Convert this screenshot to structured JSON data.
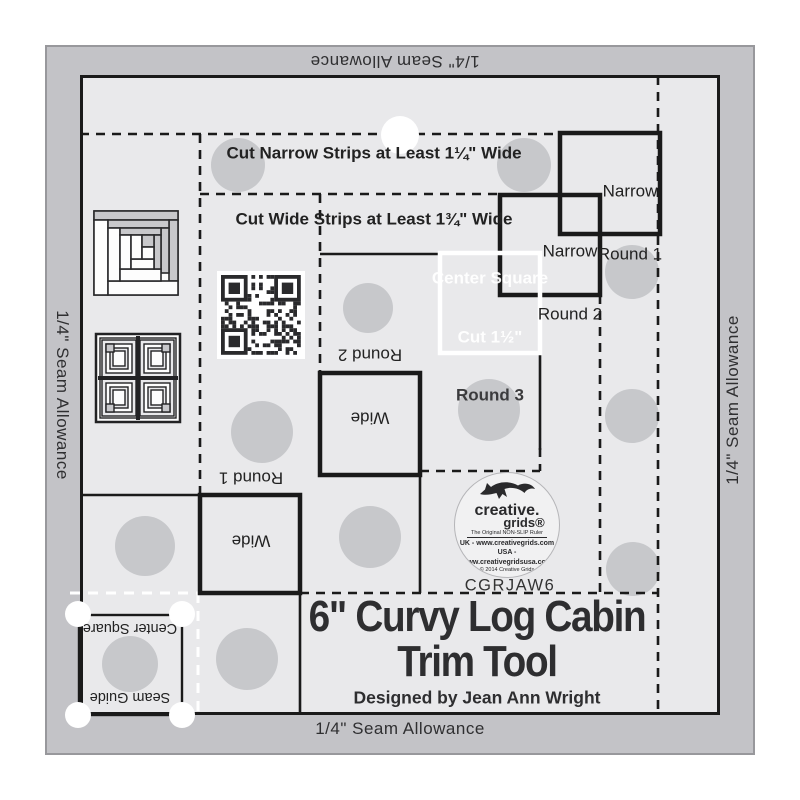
{
  "edge_labels": {
    "top": "1/4\" Seam Allowance",
    "bottom": "1/4\" Seam Allowance",
    "left": "1/4\" Seam Allowance",
    "right": "1/4\" Seam Allowance"
  },
  "strip_instructions": {
    "line1": "Cut Narrow Strips at Least 1¼\" Wide",
    "line2": "Cut Wide Strips at Least 1¾\" Wide"
  },
  "round_labels": {
    "narrow_round_1": [
      "Narrow",
      "Round 1"
    ],
    "narrow_round_2": [
      "Narrow",
      "Round 2"
    ],
    "wide_round_2": [
      "Wide",
      "Round 2"
    ],
    "wide_round_1": [
      "Wide",
      "Round 1"
    ]
  },
  "center_square": {
    "line1": "Center Square",
    "line2": "Cut 1½\"",
    "line3": "Round 3"
  },
  "corner_guide": {
    "top_label": "Center Square",
    "bottom_label": "Seam Guide"
  },
  "logo": {
    "brand_line1": "creative.",
    "brand_line2": "grids®",
    "tagline": "The Original NON-SLIP Ruler",
    "uk_line": "UK - www.creativegrids.com",
    "usa_line": "USA - www.creativegridsusa.com",
    "copyright_line": "© 2014 Creative Grids",
    "made_in": "MADE IN USA"
  },
  "product_code": "CGRJAW6",
  "title": {
    "line1": "6\" Curvy Log Cabin",
    "line2": "Trim Tool",
    "designer": "Designed by Jean Ann Wright"
  },
  "colors": {
    "band": "#c3c3c7",
    "plate": "#e9e9eb",
    "line": "#1a1a1a",
    "grip_circle": "#c7c8cb",
    "white_marking": "#ffffff",
    "text": "#2d2d2f"
  }
}
